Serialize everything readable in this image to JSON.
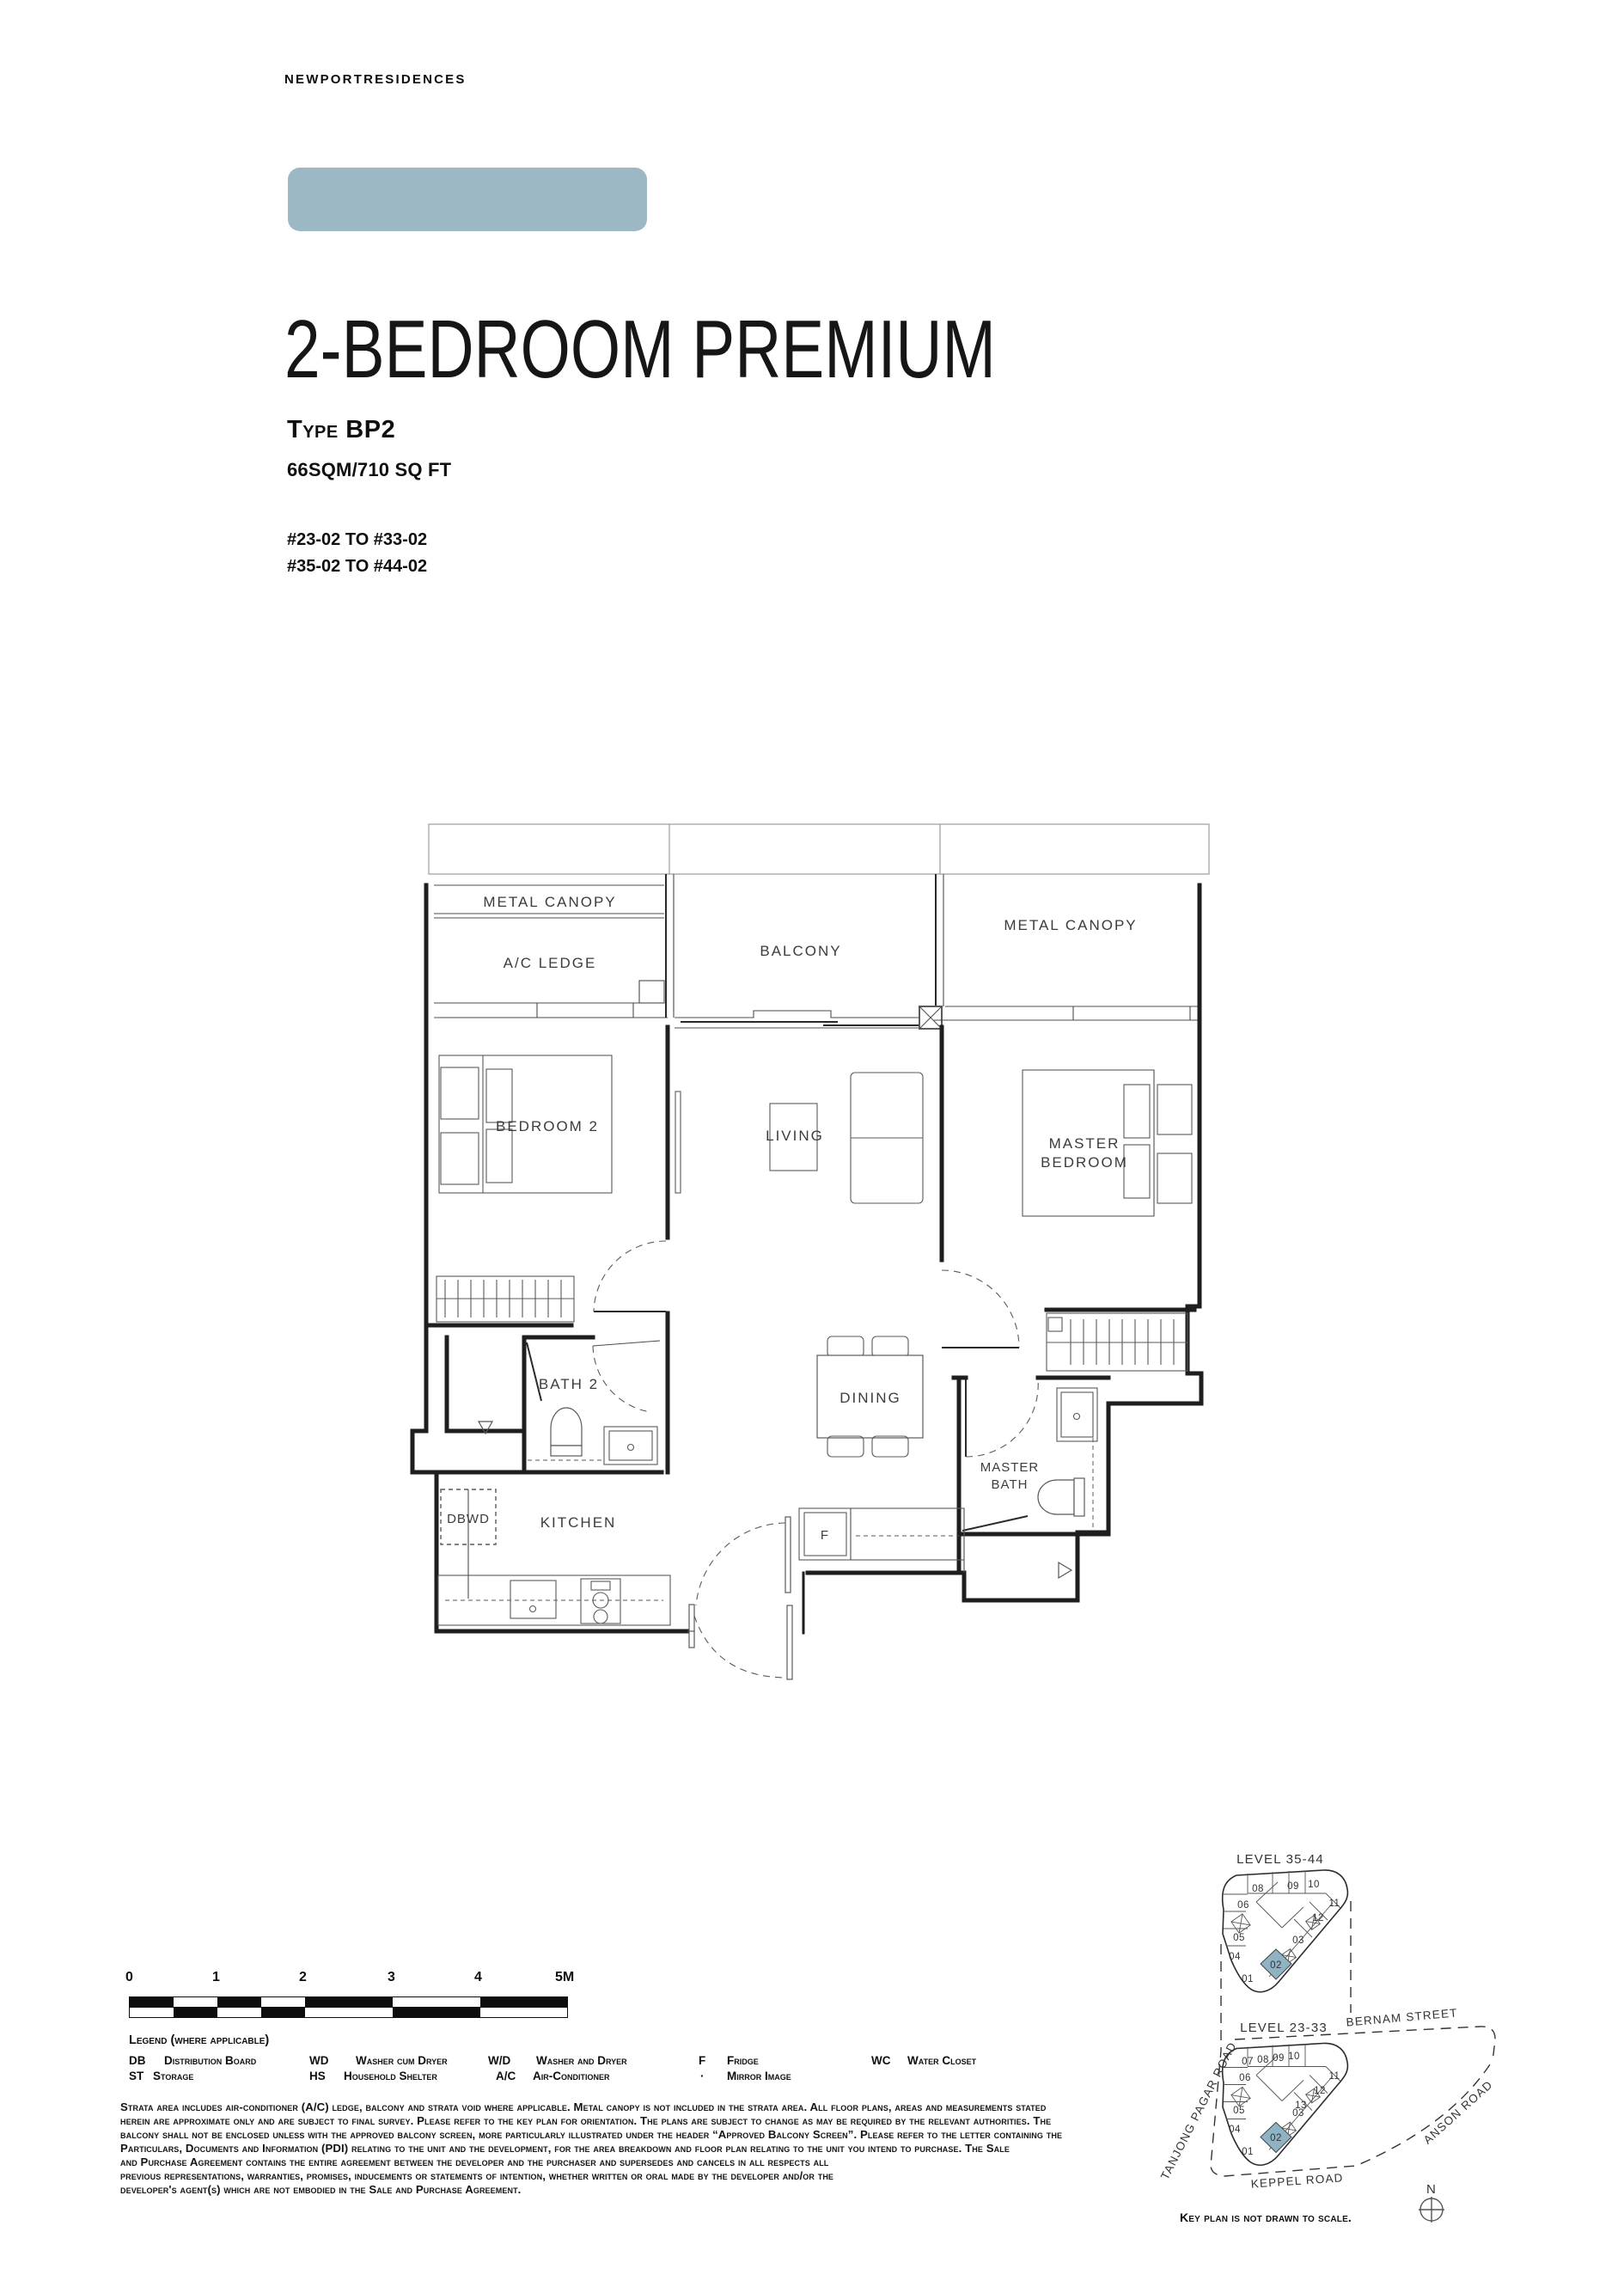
{
  "brand": {
    "logo": "NEWPORTRESIDENCES"
  },
  "header": {
    "title": "2-BEDROOM PREMIUM",
    "unit_type": "Type BP2",
    "area": "66SQM/710 SQ FT",
    "stacks": [
      "#23-02 TO #33-02",
      "#35-02 TO #44-02"
    ]
  },
  "floorplan": {
    "rooms": {
      "metal_canopy_left": "METAL CANOPY",
      "ac_ledge": "A/C LEDGE",
      "balcony": "BALCONY",
      "metal_canopy_right": "METAL CANOPY",
      "bedroom2": "BEDROOM 2",
      "living": "LIVING",
      "master_bedroom_1": "MASTER",
      "master_bedroom_2": "BEDROOM",
      "bath2": "BATH 2",
      "dining": "DINING",
      "master_bath_1": "MASTER",
      "master_bath_2": "BATH",
      "dbwd": "DBWD",
      "kitchen": "KITCHEN",
      "fridge": "F"
    }
  },
  "scalebar": {
    "ticks": [
      "0",
      "1",
      "2",
      "3",
      "4",
      "5M"
    ]
  },
  "legend": {
    "title": "Legend (where applicable)",
    "entries": [
      {
        "abbr": "DB",
        "label": "Distribution Board"
      },
      {
        "abbr": "ST",
        "label": "Storage"
      },
      {
        "abbr": "WD",
        "label": "Washer cum Dryer"
      },
      {
        "abbr": "HS",
        "label": "Household Shelter"
      },
      {
        "abbr": "W/D",
        "label": "Washer and Dryer"
      },
      {
        "abbr": "A/C",
        "label": "Air-Conditioner"
      },
      {
        "abbr": "F",
        "label": "Fridge"
      },
      {
        "abbr": "·",
        "label": "Mirror Image"
      },
      {
        "abbr": "WC",
        "label": "Water Closet"
      }
    ]
  },
  "disclaimer": {
    "lines": [
      "Strata area includes air-conditioner (A/C) ledge, balcony and strata void where applicable. Metal canopy is not included in the strata area. All floor plans, areas and measurements stated",
      "herein are approximate only and are subject to final survey. Please refer to the key plan for orientation. The plans are subject to change as may be required by the relevant authorities. The",
      "balcony shall not be enclosed unless with the approved balcony screen, more particularly illustrated under the header “Approved Balcony Screen”. Please refer to the letter containing the",
      "Particulars, Documents and Information (PDI) relating to the unit and the development, for the area breakdown and floor plan relating to the unit you intend to purchase. The Sale",
      "and Purchase Agreement contains the entire agreement between the developer and the purchaser and supersedes and cancels in all respects all",
      "previous representations, warranties, promises, inducements or statements of intention, whether written or oral made by the developer and/or the",
      "developer's agent(s) which are not embodied in the Sale and Purchase Agreement."
    ]
  },
  "keyplan": {
    "upper_title": "LEVEL 35-44",
    "lower_title": "LEVEL 23-33",
    "upper_units": [
      "08",
      "09",
      "10",
      "06",
      "11",
      "12",
      "05",
      "03",
      "04",
      "01",
      "02"
    ],
    "lower_units": [
      "07",
      "08",
      "09",
      "10",
      "06",
      "11",
      "12",
      "13",
      "05",
      "03",
      "04",
      "01",
      "02"
    ],
    "streets": {
      "bernam": "BERNAM STREET",
      "tanjong": "TANJONG PAGAR ROAD",
      "anson": "ANSON ROAD",
      "keppel": "KEPPEL ROAD"
    },
    "note": "Key plan is not drawn to scale.",
    "compass": "N"
  },
  "colors": {
    "accent_bar": "#9cb8c5",
    "unit_highlight": "#8fb3c3"
  }
}
